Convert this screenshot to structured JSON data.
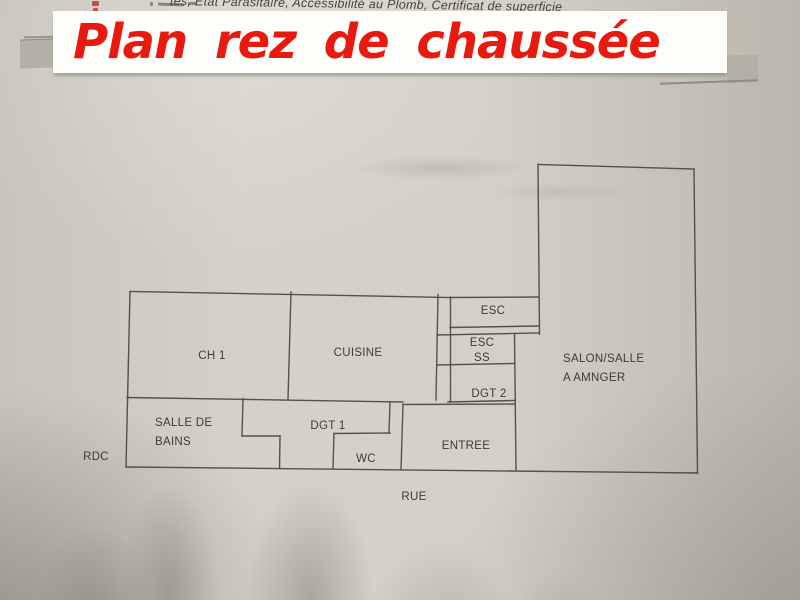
{
  "header": {
    "strip_text": "tes, Etat Parasitaire, Accessibilité au Plomb, Certificat de superficie",
    "title": "Plan rez de chaussée"
  },
  "plan": {
    "rooms": [
      {
        "id": "ch1",
        "label": "CH 1"
      },
      {
        "id": "cuisine",
        "label": "CUISINE"
      },
      {
        "id": "esc",
        "label": "ESC"
      },
      {
        "id": "esc_ss",
        "line1": "ESC",
        "line2": "SS"
      },
      {
        "id": "dgt2",
        "label": "DGT 2"
      },
      {
        "id": "salon",
        "line1": "SALON/SALLE",
        "line2": "A AMNGER"
      },
      {
        "id": "salle_de_bains",
        "line1": "SALLE DE",
        "line2": "BAINS"
      },
      {
        "id": "dgt1",
        "label": "DGT 1"
      },
      {
        "id": "wc",
        "label": "WC"
      },
      {
        "id": "entree",
        "label": "ENTREE"
      }
    ],
    "floor_label": "RDC",
    "street_label": "RUE"
  },
  "colors": {
    "title_red": "#e8190f",
    "banner_bg": "#fdfdfa",
    "paper": "#d2cec4",
    "wall_line": "#4a473f",
    "tab_gray": "#b3b0a6"
  }
}
